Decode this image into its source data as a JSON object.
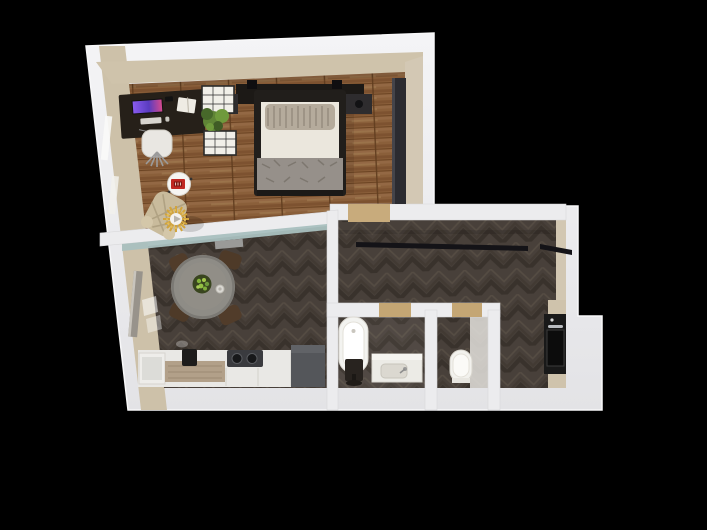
{
  "scene": {
    "title": "3d-apartment-floor-plan-top-view",
    "background": "#000000",
    "palette": {
      "wall_white_light": "#f3f3f5",
      "wall_white_dark": "#e2e2e6",
      "wall_face_beige": "#cdc1a9",
      "wall_face_tan": "#d8cdb6",
      "wood_floor": "#8a5f3a",
      "herringbone_base": "#48403a",
      "glass_teal": "#a9c0bf",
      "threshold_tan": "#c8ab7c",
      "black_furniture": "#1c1916",
      "white_furniture": "#efeeea",
      "gray_cabinet": "#54565a",
      "table_concrete": "#8e8c86",
      "chair_brown": "#513c2a",
      "bowl_green_dark": "#39451f",
      "greenery": "#6f9a3c",
      "accent_red": "#c02822",
      "accent_gold": "#d2a43c",
      "blanket_gray": "#96908a",
      "pillow_beige": "#b5ab9c",
      "armchair_beige": "#c9bb9c",
      "counter_wood": "#b2a089",
      "cooktop_dark": "#3a3b3f",
      "screen_purple_a": "#8a5cf0",
      "screen_purple_b": "#d94a8c",
      "radiator_gray": "#98938b"
    },
    "rooms": [
      {
        "id": "bedroom",
        "floor": "wood-plank"
      },
      {
        "id": "living-room-kitchen",
        "floor": "dark-herringbone"
      },
      {
        "id": "hallway",
        "floor": "dark-herringbone"
      },
      {
        "id": "bathroom",
        "floor": "dark-herringbone"
      },
      {
        "id": "wc",
        "floor": "dark-herringbone"
      }
    ],
    "furniture": {
      "bedroom": [
        "double-bed",
        "headboard",
        "nightstand-left",
        "nightstand-right",
        "desk",
        "monitor",
        "office-chair",
        "shelf-rack",
        "potted-plant",
        "round-side-table",
        "red-radio-clock",
        "armchair",
        "sunburst-decor",
        "wardrobe",
        "radiator-windows"
      ],
      "living_room": [
        "dining-table",
        "fruit-bowl",
        "cup",
        "dining-chair x4",
        "kitchen-counter",
        "cooktop",
        "coffee-machine",
        "dark-tall-cabinet",
        "radiator"
      ],
      "hallway": [
        "wardrobe-rail",
        "oven-column",
        "door-thresholds"
      ],
      "bathroom": [
        "bathtub",
        "vanity-sink",
        "dark-stool"
      ],
      "wc": [
        "toilet"
      ]
    }
  }
}
